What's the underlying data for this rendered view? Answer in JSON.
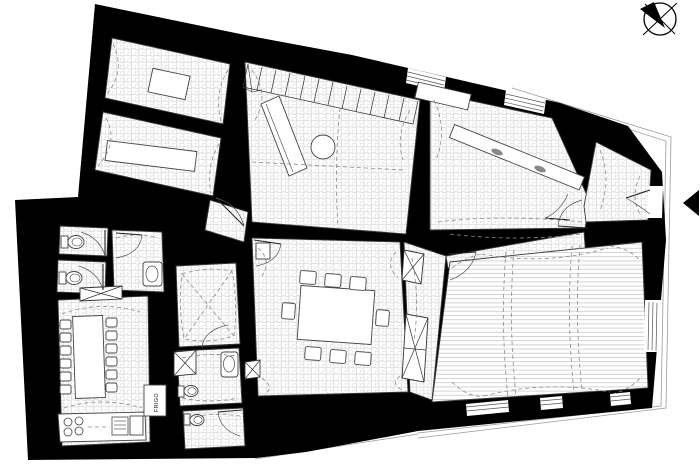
{
  "plan": {
    "labels": {
      "fridge": "FRIGO"
    },
    "icons": {
      "compass": "compass-rose-icon",
      "entrance": "entrance-arrow-icon",
      "stairs": "stairs-icon",
      "toilet": "toilet-icon",
      "sink": "sink-icon",
      "stove": "stove-icon",
      "shaft": "crossed-shaft-icon"
    },
    "colors": {
      "walls": "#000000",
      "background": "#ffffff",
      "tile_hatch": "#d2d2d2",
      "plank_hatch": "#c9c9c9",
      "vault_dash": "#8a8a8a"
    }
  }
}
